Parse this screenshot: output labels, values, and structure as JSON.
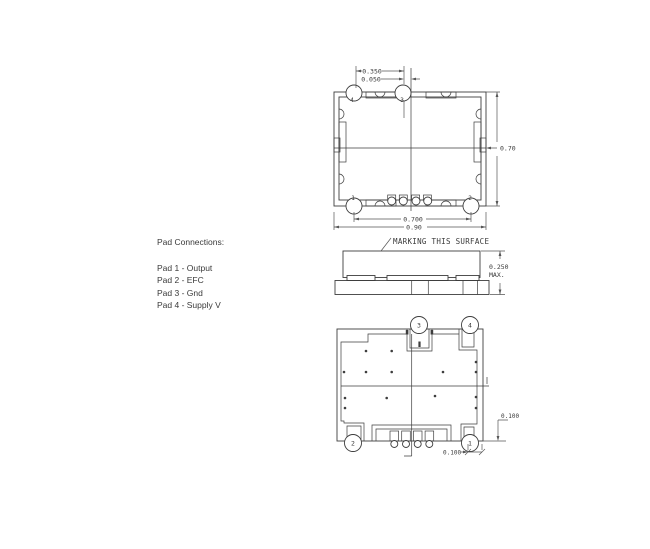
{
  "colors": {
    "line": "#3d3d3d",
    "dim": "#565656",
    "text": "#3a3a3a"
  },
  "pad_connections": {
    "title": "Pad Connections:",
    "items": [
      "Pad 1 - Output",
      "Pad 2 - EFC",
      "Pad 3 - Gnd",
      "Pad 4 - Supply V"
    ]
  },
  "top_view": {
    "pads": {
      "p1": "1",
      "p2": "2",
      "p3": "3",
      "p4": "4"
    },
    "dims": {
      "pad3_pitch": "0.350",
      "pad3_offset": "0.050",
      "body_height": "0.70",
      "pad_pitch": "0.700",
      "body_width": "0.90"
    }
  },
  "side_view": {
    "marking_note": "MARKING THIS SURFACE",
    "dims": {
      "max_height": "0.250",
      "max_label": "MAX."
    }
  },
  "bottom_view": {
    "pads": {
      "p1": "1",
      "p2": "2",
      "p3": "3",
      "p4": "4"
    },
    "dims": {
      "pad_height": "0.100",
      "pad_width": "0.100"
    }
  }
}
